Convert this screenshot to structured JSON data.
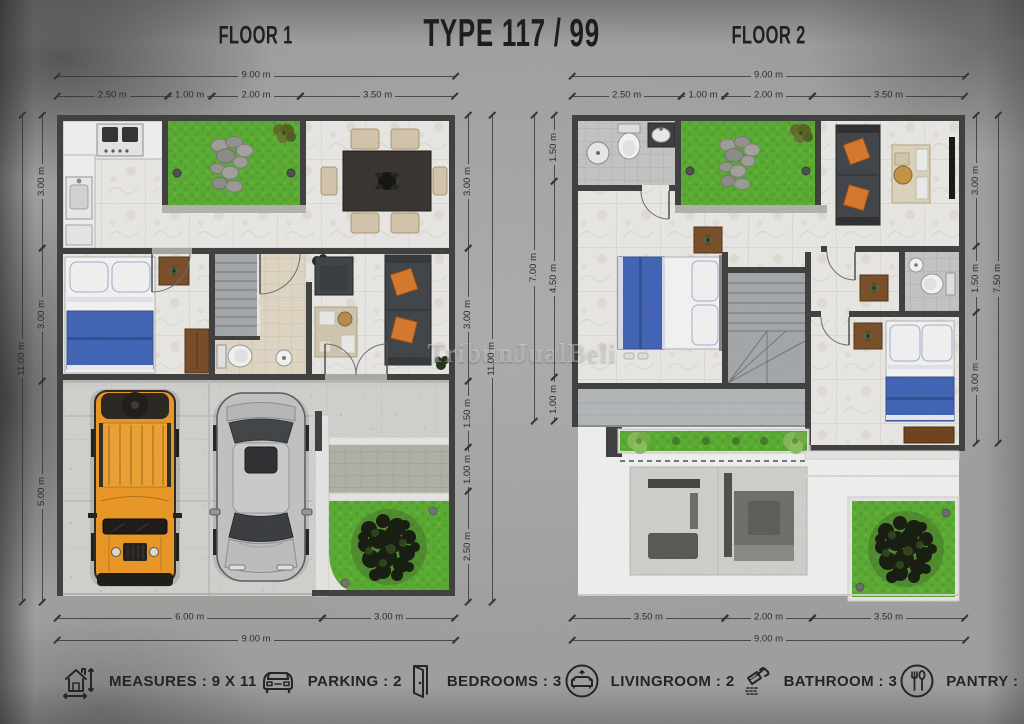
{
  "title": "TYPE 117 / 99",
  "watermark": "TribunJualBeli",
  "floor1": {
    "label": "FLOOR 1",
    "dims": {
      "top_total": "9.00 m",
      "top": [
        "2.50 m",
        "1.00 m",
        "2.00 m",
        "3.50 m"
      ],
      "left_total": "11.00 m",
      "left": [
        "3.00 m",
        "3.00 m",
        "5.00 m"
      ],
      "right": [
        "3.00 m",
        "3.00 m",
        "1.50 m",
        "1.00 m",
        "2.50 m"
      ],
      "right_total": "11.00 m",
      "bottom": [
        "6.00 m",
        "3.00 m"
      ],
      "bottom_total": "9.00 m"
    }
  },
  "floor2": {
    "label": "FLOOR 2",
    "dims": {
      "top_total": "9.00 m",
      "top": [
        "2.50 m",
        "1.00 m",
        "2.00 m",
        "3.50 m"
      ],
      "left_total": "7.00 m",
      "left": [
        "1.50 m",
        "4.50 m",
        "1.00 m"
      ],
      "right": [
        "3.00 m",
        "1.50 m",
        "3.00 m"
      ],
      "right_total": "7.50 m",
      "bottom": [
        "3.50 m",
        "2.00 m",
        "3.50 m"
      ],
      "bottom_total": "9.00 m"
    }
  },
  "legend": {
    "items": [
      {
        "icon": "house-measure-icon",
        "label": "MEASURES : 9 X 11"
      },
      {
        "icon": "car-icon",
        "label": "PARKING : 2"
      },
      {
        "icon": "door-icon",
        "label": "BEDROOMS : 3"
      },
      {
        "icon": "sofa-icon",
        "label": "LIVINGROOM : 2"
      },
      {
        "icon": "shower-icon",
        "label": "BATHROOM : 3"
      },
      {
        "icon": "cutlery-icon",
        "label": "PANTRY : 1"
      }
    ]
  },
  "colors": {
    "wall_dark": "#3a3a3a",
    "grass_green": "#57b02c",
    "blanket_blue": "#3c62ba",
    "car_orange": "#f59a1d",
    "cushion_orange": "#df7826",
    "marble_floor": "#f4f2ee"
  }
}
